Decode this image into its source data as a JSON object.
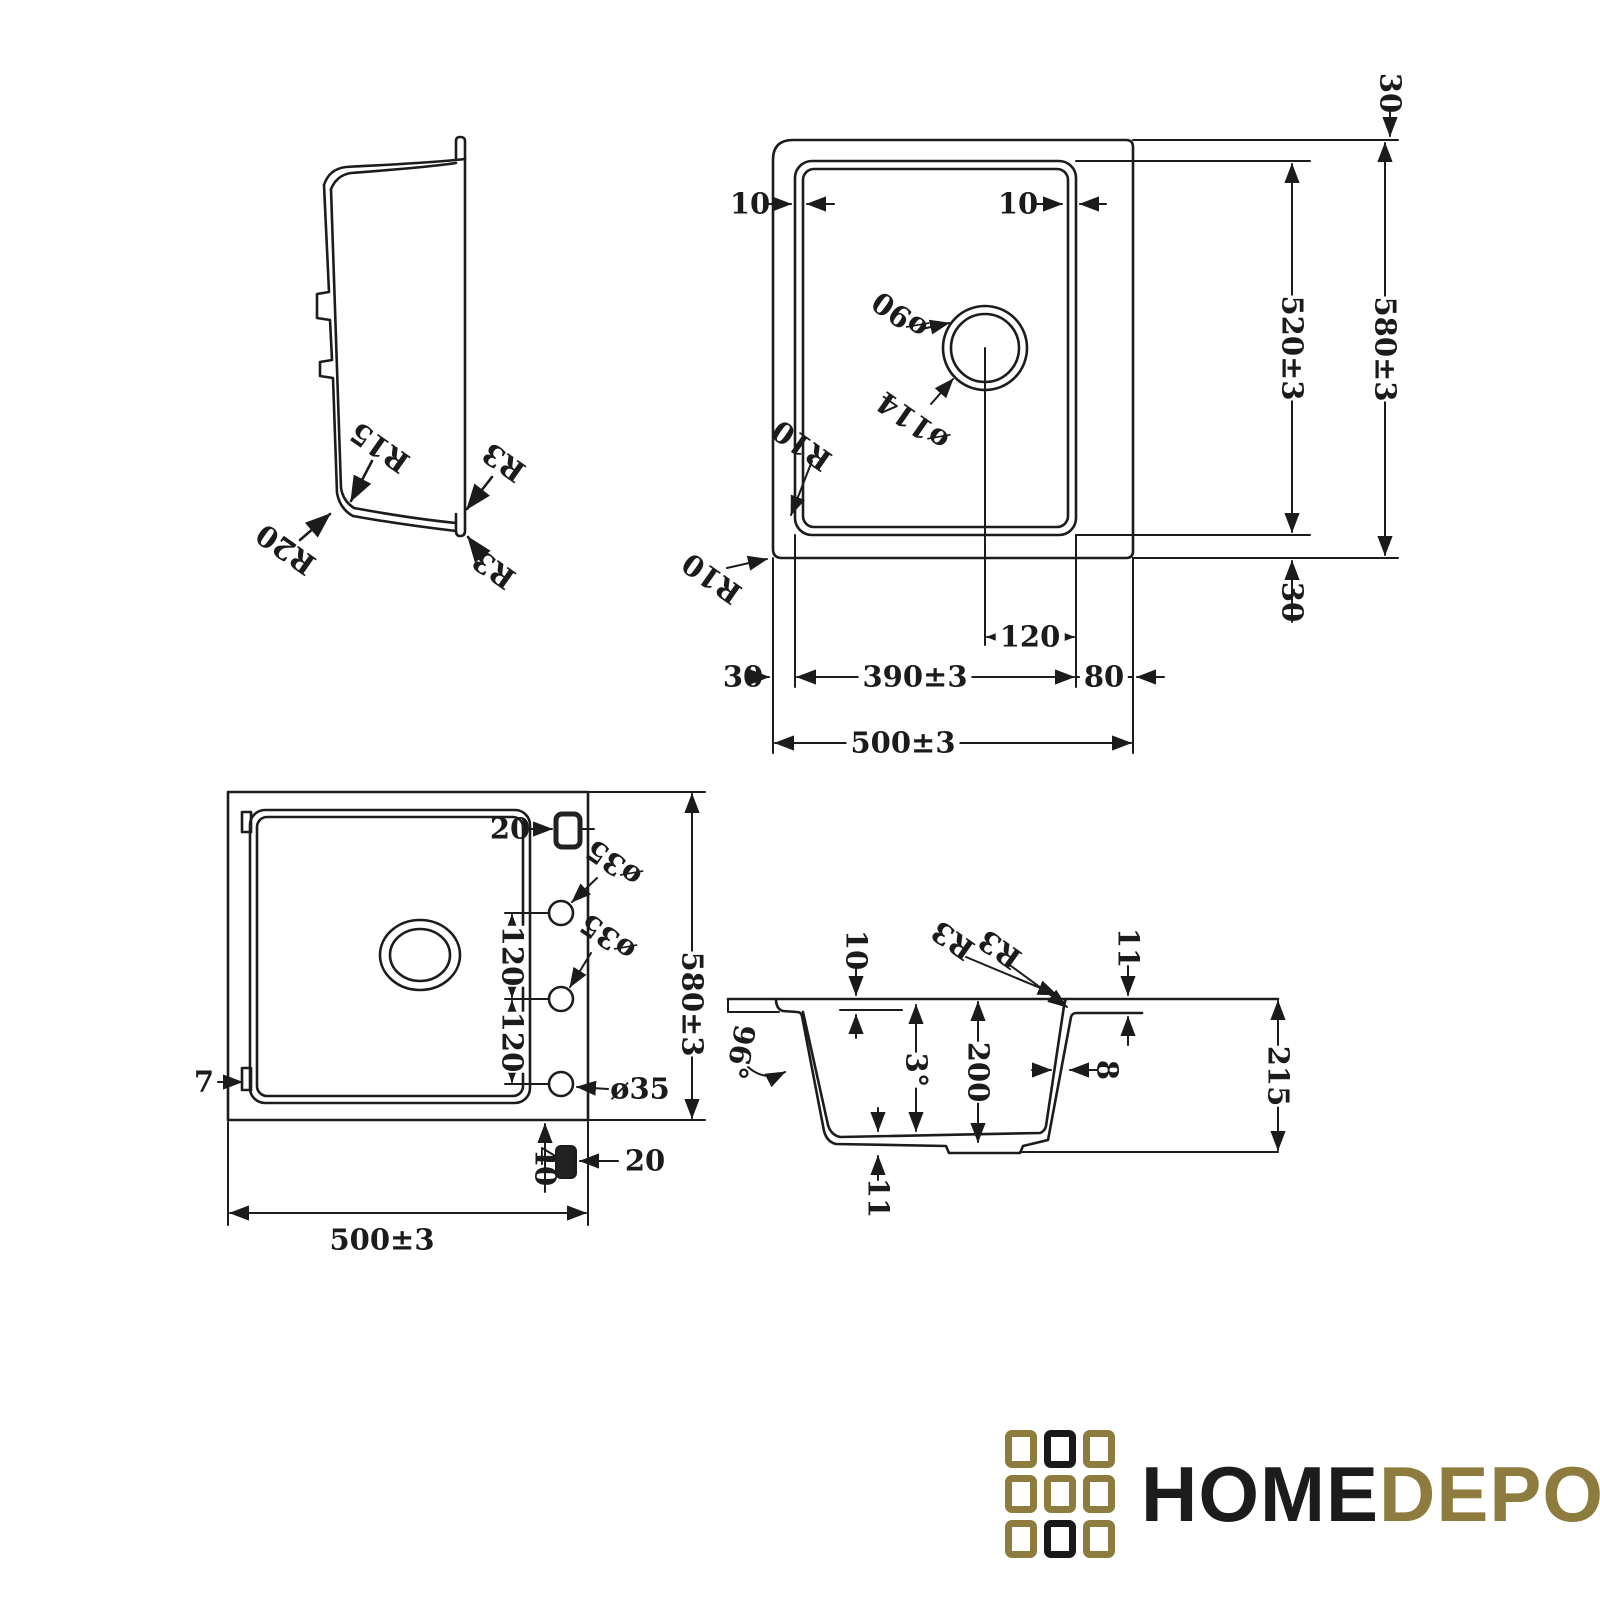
{
  "colors": {
    "line": "#1c1c1c",
    "logo_gold": "#8d7c3e",
    "logo_black": "#191919"
  },
  "views": {
    "side_profile": {
      "labels": {
        "r15": "R15",
        "r20": "R20",
        "r3_inner": "R3",
        "r3_lip": "R3"
      }
    },
    "top_plan": {
      "labels": {
        "offset_left": "10",
        "offset_right": "10",
        "drain_outer": "ø90",
        "drain_inner": "ø114",
        "r10_bowl": "R10",
        "r10_body": "R10",
        "top_margin": "30",
        "bowl_length": "520±3",
        "body_length": "580±3",
        "bottom_margin": "30",
        "drain_offset": "120",
        "left_margin": "30",
        "bowl_width": "390±3",
        "right_margin": "80",
        "body_width": "500±3"
      }
    },
    "bottom_plan": {
      "labels": {
        "clip_top": "20",
        "tap_hole_1": "ø35",
        "tap_hole_2": "ø35",
        "tap_hole_3": "ø35",
        "hole_spacing_1": "120",
        "hole_spacing_2": "120",
        "body_length": "580±3",
        "edge_offset": "7",
        "clip_bottom": "20",
        "bottom_offset": "40",
        "body_width": "500±3"
      }
    },
    "cross_section": {
      "labels": {
        "rim_depth": "10",
        "r3_top": "R3",
        "r3_step": "R3",
        "flange_thickness": "11",
        "wall_angle": "96°",
        "base_angle": "3°",
        "bowl_depth": "200",
        "wall_thickness": "8",
        "overall_depth": "215",
        "base_thickness": "11"
      }
    }
  },
  "logo": {
    "name_primary": "HOME",
    "name_secondary": "DEPO",
    "grid_pattern": [
      "gold",
      "black",
      "gold",
      "gold",
      "gold",
      "gold",
      "gold",
      "black",
      "gold"
    ]
  }
}
